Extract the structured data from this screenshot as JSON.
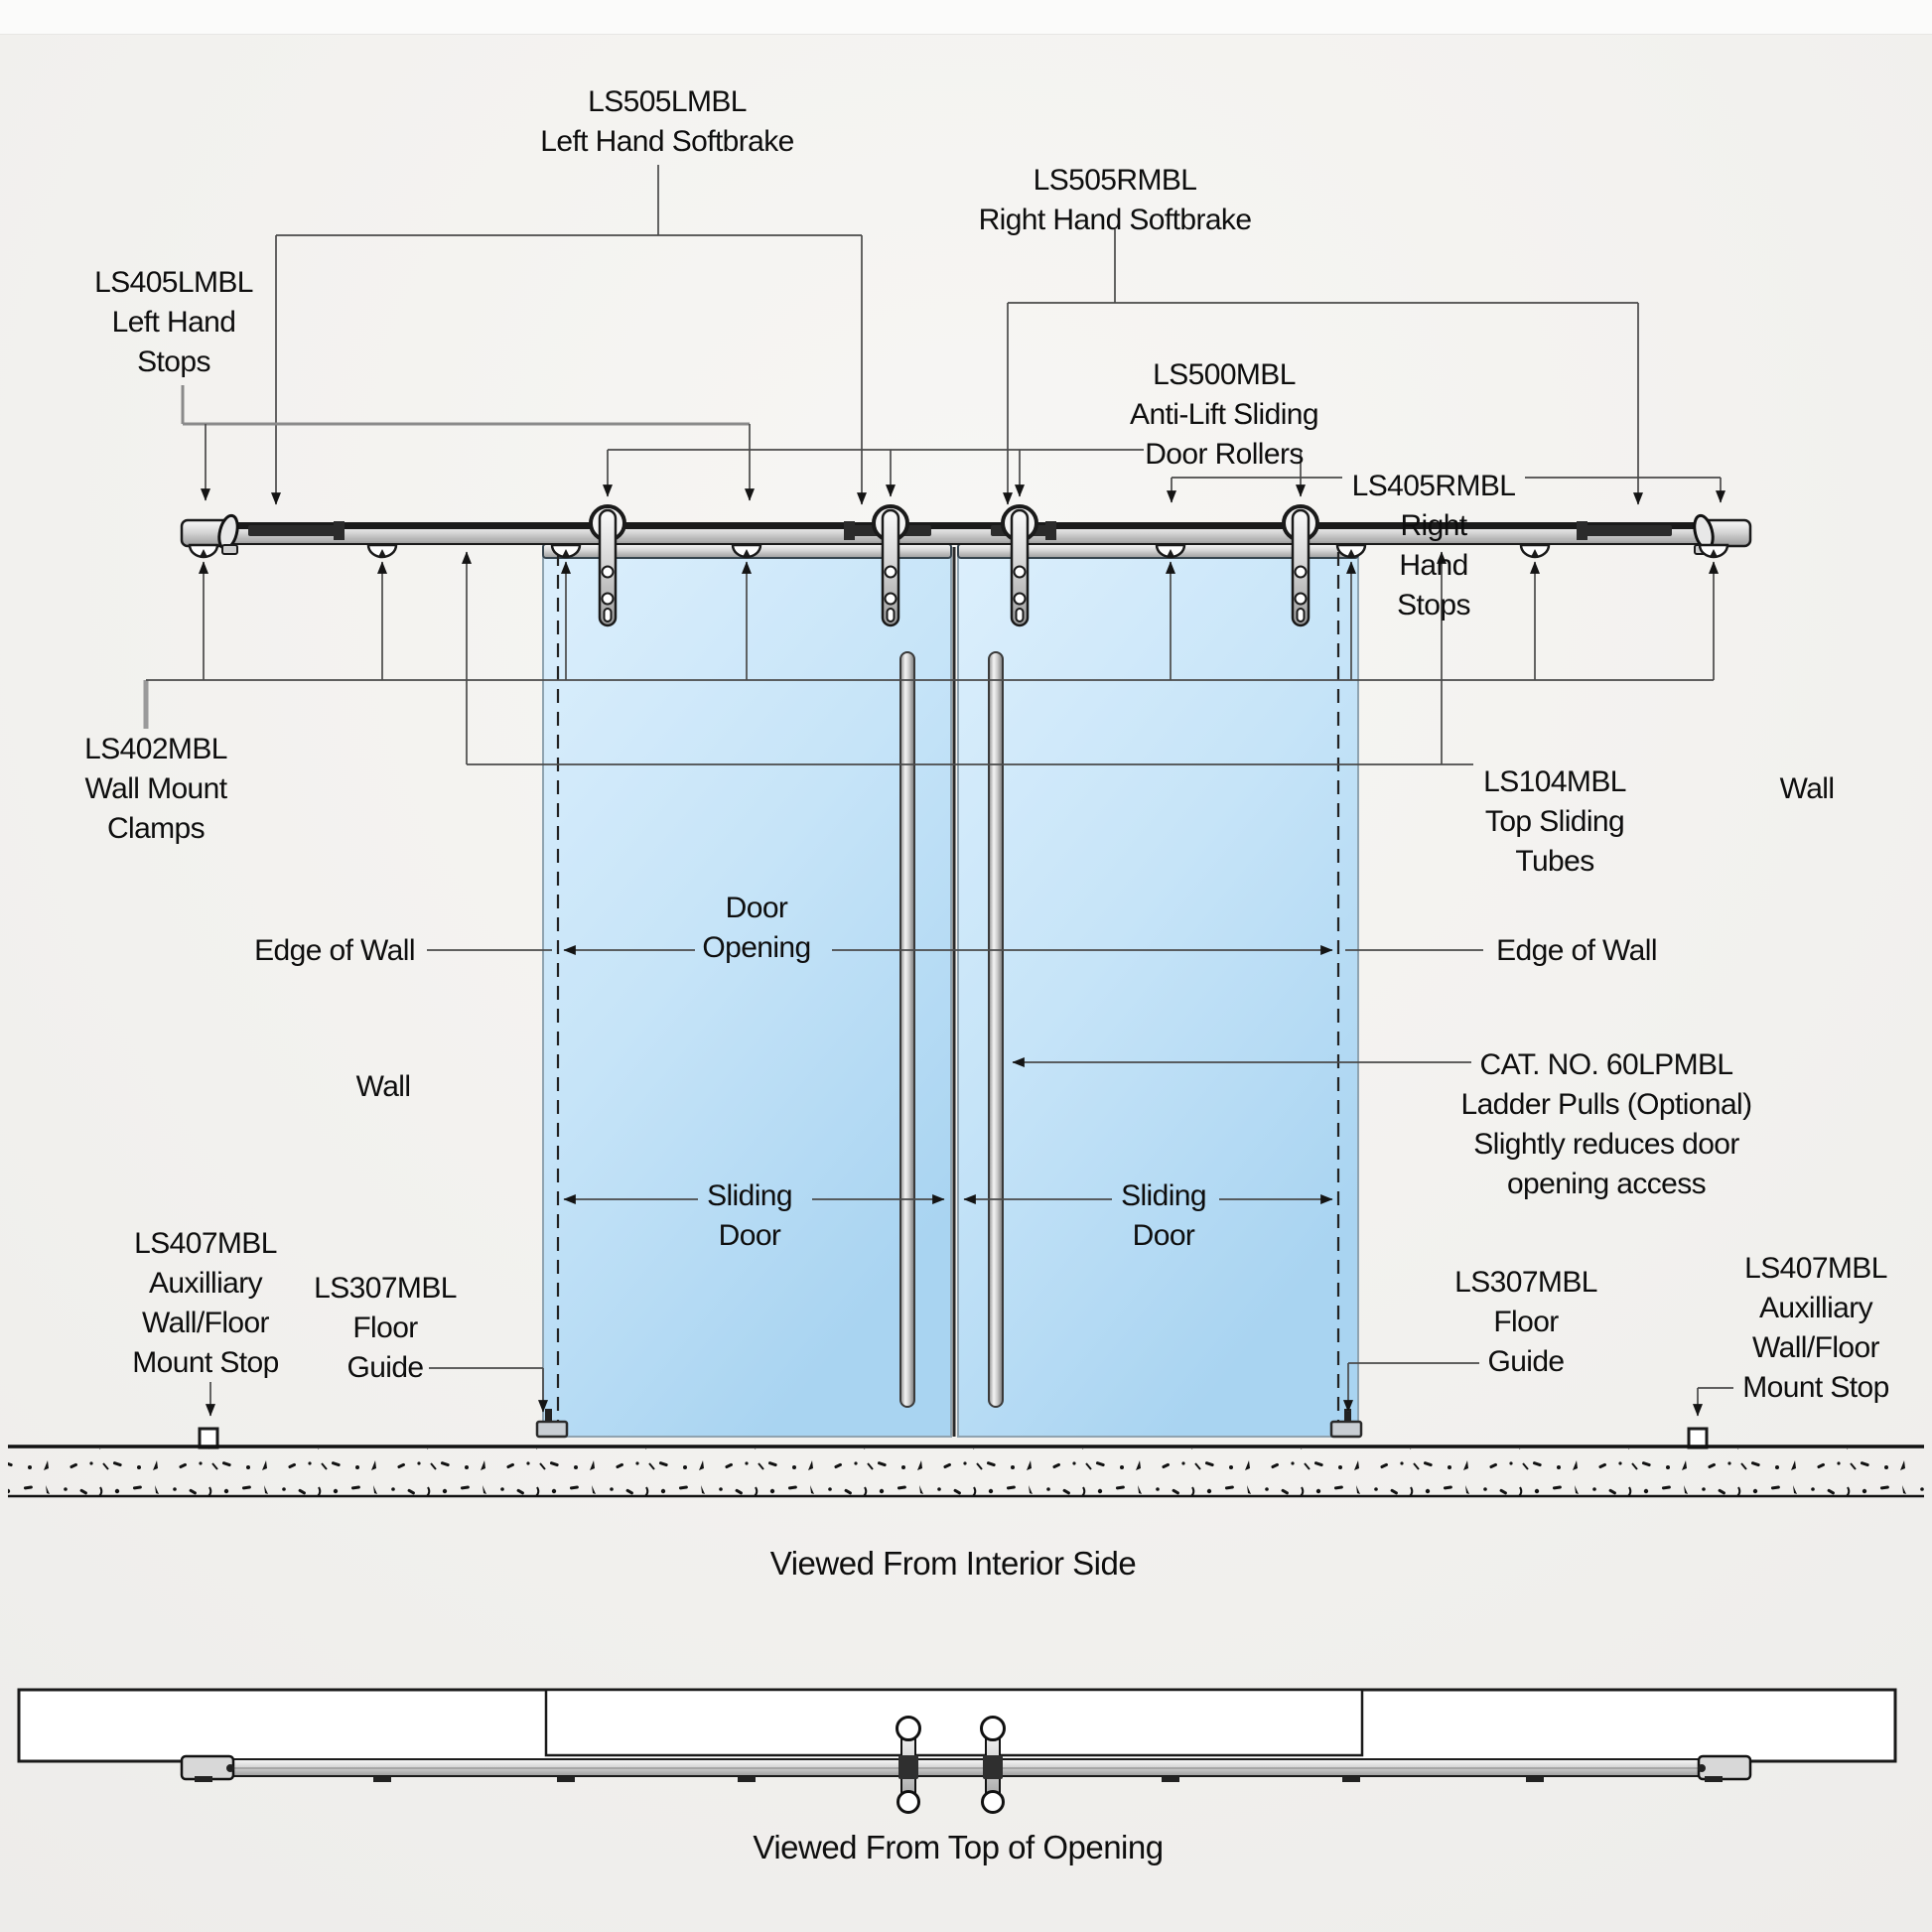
{
  "labels": {
    "ls505_left": {
      "lines": [
        "LS505LMBL",
        "Left Hand Softbrake"
      ]
    },
    "ls505_right": {
      "lines": [
        "LS505RMBL",
        "Right Hand Softbrake"
      ]
    },
    "ls405_left": {
      "lines": [
        "LS405LMBL",
        "Left Hand",
        "Stops"
      ]
    },
    "ls500": {
      "lines": [
        "LS500MBL",
        "Anti-Lift Sliding",
        "Door Rollers"
      ]
    },
    "ls405_right": {
      "lines": [
        "LS405RMBL",
        "Right",
        "Hand",
        "Stops"
      ]
    },
    "ls402": {
      "lines": [
        "LS402MBL",
        "Wall Mount",
        "Clamps"
      ]
    },
    "ls104": {
      "lines": [
        "LS104MBL",
        "Top Sliding",
        "Tubes"
      ]
    },
    "wall_left": {
      "lines": [
        "Wall"
      ]
    },
    "wall_right": {
      "lines": [
        "Wall"
      ]
    },
    "edge_of_wall_left": {
      "lines": [
        "Edge of Wall"
      ]
    },
    "edge_of_wall_right": {
      "lines": [
        "Edge of Wall"
      ]
    },
    "door_opening": {
      "lines": [
        "Door",
        "Opening"
      ]
    },
    "sliding_door_left": {
      "lines": [
        "Sliding",
        "Door"
      ]
    },
    "sliding_door_right": {
      "lines": [
        "Sliding",
        "Door"
      ]
    },
    "ladder_pulls": {
      "lines": [
        "CAT. NO. 60LPMBL",
        "Ladder Pulls (Optional)",
        "Slightly reduces door",
        "opening access"
      ]
    },
    "ls407_left": {
      "lines": [
        "LS407MBL",
        "Auxilliary",
        "Wall/Floor",
        "Mount Stop"
      ]
    },
    "ls307_left": {
      "lines": [
        "LS307MBL",
        "Floor",
        "Guide"
      ]
    },
    "ls307_right": {
      "lines": [
        "LS307MBL",
        "Floor",
        "Guide"
      ]
    },
    "ls407_right": {
      "lines": [
        "LS407MBL",
        "Auxilliary",
        "Wall/Floor",
        "Mount Stop"
      ]
    }
  },
  "captions": {
    "interior_view": "Viewed From Interior Side",
    "top_view": "Viewed From Top of Opening"
  },
  "colors": {
    "background": "#f2f1ee",
    "glass_top": "#dceffc",
    "glass_mid": "#c6e4f8",
    "glass_bottom": "#a9d4f1",
    "line": "#1a1a1a"
  }
}
